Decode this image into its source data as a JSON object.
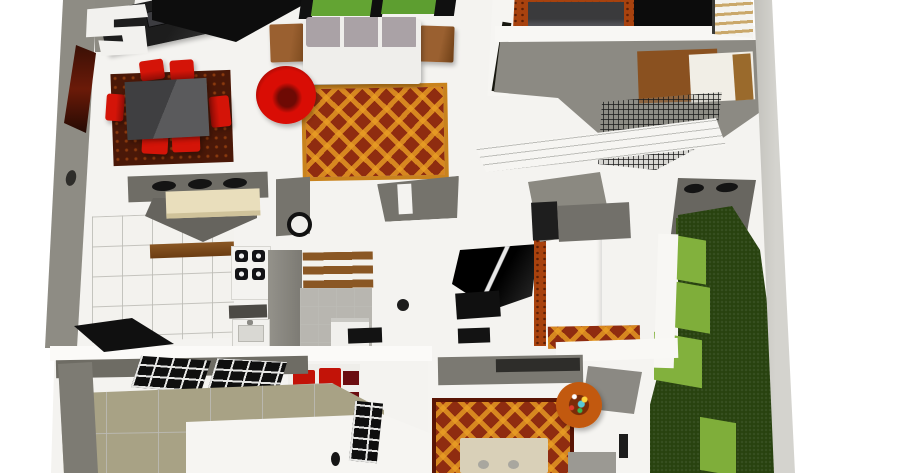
{
  "scene": {
    "title": "3D rendered bird's-eye house floor plan",
    "rooms": {
      "office": "home office corner with dark desk, computer and white chair",
      "dining": "dining area with dark grey table and six red chairs on a dark red rug",
      "living": "living room with grey sofa, two wooden side tables, red round easy chair and ornate orange carpet",
      "kitchen": "kitchen with breakfast bar, three stools, stove, sink and grey counters",
      "pantry": "pantry with wooden shelves, tiled floor and washer",
      "bathroom": "bathroom with dark glass shower, black mat and vanity",
      "bedroom_top": "upper bedroom with dark bed on orange fur rug",
      "bedroom_right": "right bedroom loft with wooden bed, white mattress and wire mesh railing",
      "bedroom_bottom": "lower bedroom with tan bed, ornate orange rug, flower pouf and red loveseat",
      "courtyard": "small courtyard with grey floor, two dark vents and green mat",
      "garden": "side garden with dark lawn and light green grass pavers",
      "patio": "front patio with khaki tiled floor and black framed windows",
      "porch": "white entry porch"
    },
    "furniture": {
      "office": [
        "desk",
        "computer",
        "white-office-chair"
      ],
      "dining": [
        "dining-table",
        "red-chair-1",
        "red-chair-2",
        "red-chair-3",
        "red-chair-4",
        "red-chair-5",
        "red-chair-6",
        "dark-red-rug"
      ],
      "living": [
        "sofa",
        "side-table-left",
        "side-table-right",
        "red-donut-chair",
        "ornate-rug"
      ],
      "kitchen": [
        "breakfast-bar",
        "bar-stool-1",
        "bar-stool-2",
        "bar-stool-3",
        "stove-4-burners",
        "sink",
        "wok-pan",
        "wall-shelf",
        "counters"
      ],
      "bedroom_bottom": [
        "tan-bed",
        "flower-pouf",
        "red-loveseat",
        "maroon-cabinet",
        "window-grid",
        "ornate-rug"
      ],
      "bedroom_right": [
        "wooden-bed",
        "white-mattress",
        "mesh-railing",
        "ladder"
      ],
      "garden": [
        "grass-paver-1",
        "grass-paver-2",
        "grass-paver-3",
        "grass-paver-4"
      ]
    },
    "palette": {
      "background": "#ffffff",
      "floor_white": "#f4f3f0",
      "wall_gray": "#8e8c84",
      "wall_light": "#cbcac5",
      "accent_red": "#d41408",
      "rug_base": "#8f2c10",
      "rug_gold": "#e99e24",
      "wood_brown": "#8a5424",
      "grass_dark": "#28420f",
      "grass_light": "#82b13d",
      "patio_khaki": "#a8a285",
      "counter_cream": "#e9debc"
    }
  }
}
